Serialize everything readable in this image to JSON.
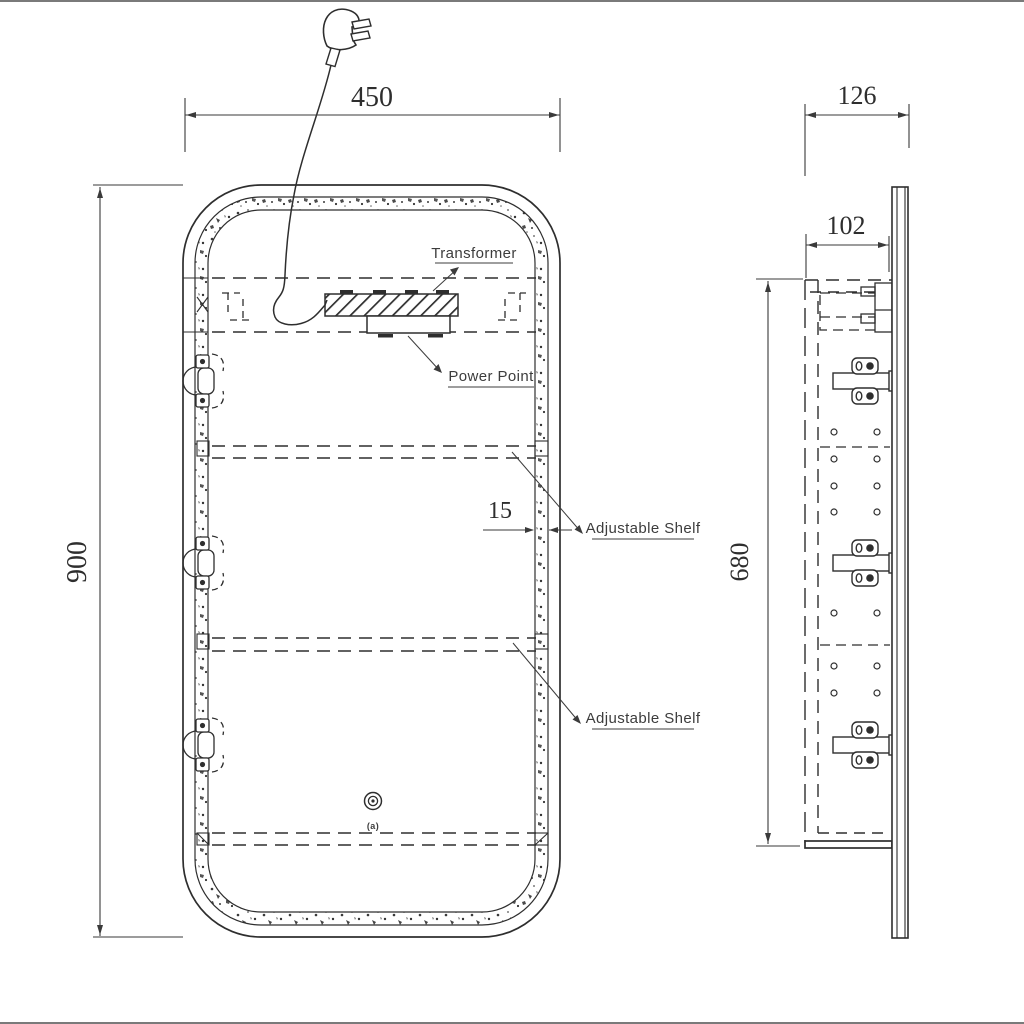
{
  "page": {
    "background": "#ffffff",
    "line_color": "#2e2e2e",
    "drawing_type": "mirror cabinet technical drawing"
  },
  "front_view": {
    "dim_width": "450",
    "dim_height": "900",
    "dim_frame_thickness": "15",
    "label_transformer": "Transformer",
    "label_power_point": "Power Point",
    "label_shelf_upper": "Adjustable Shelf",
    "label_shelf_lower": "Adjustable Shelf",
    "touch_switch_caption": "(a)"
  },
  "side_view": {
    "dim_overall_depth": "126",
    "dim_cabinet_depth": "102",
    "dim_cabinet_height": "680"
  }
}
